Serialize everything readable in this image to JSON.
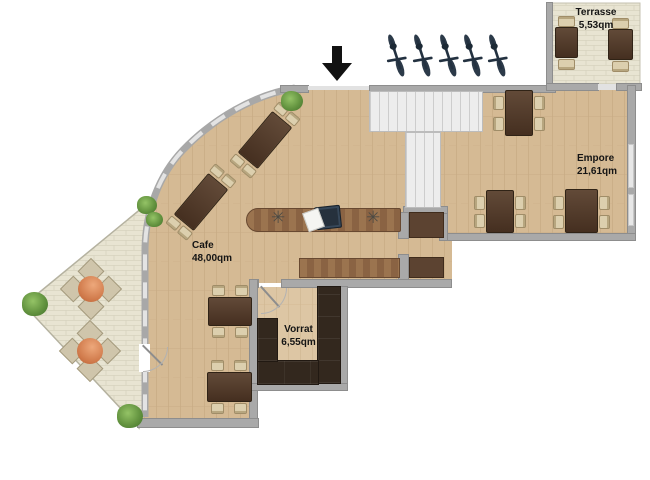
{
  "floorplan": {
    "rooms": [
      {
        "id": "terrasse",
        "label": "Terrasse",
        "area": "5,53qm"
      },
      {
        "id": "empore",
        "label": "Empore",
        "area": "21,61qm"
      },
      {
        "id": "cafe",
        "label": "Cafe",
        "area": "48,00qm"
      },
      {
        "id": "vorrat",
        "label": "Vorrat",
        "area": "6,55qm"
      }
    ],
    "icons": {
      "entrance_arrow": "solid black down-arrow at entrance",
      "bicycle_icon_count": 5,
      "outdoor_seating_groups": 2,
      "plant_icons": 5,
      "flower_decor": "✳"
    },
    "colors": {
      "wood_floor": "#d5ba94",
      "wood_floor_light": "#ddc6a4",
      "stone_floor": "#e8e4d2",
      "wall": "#a9a9a9",
      "window": "#e7e7e7",
      "stairs": "#ededed",
      "table_dark": "#54402f",
      "chair_beige": "#dccfae",
      "counter_wood": "#9b744f",
      "shelf_dark": "#33281e",
      "outdoor_table_orange": "#d07a4b",
      "plant_green": "#649440",
      "bike_navy": "#2c3a49",
      "label_text": "#141414"
    }
  }
}
